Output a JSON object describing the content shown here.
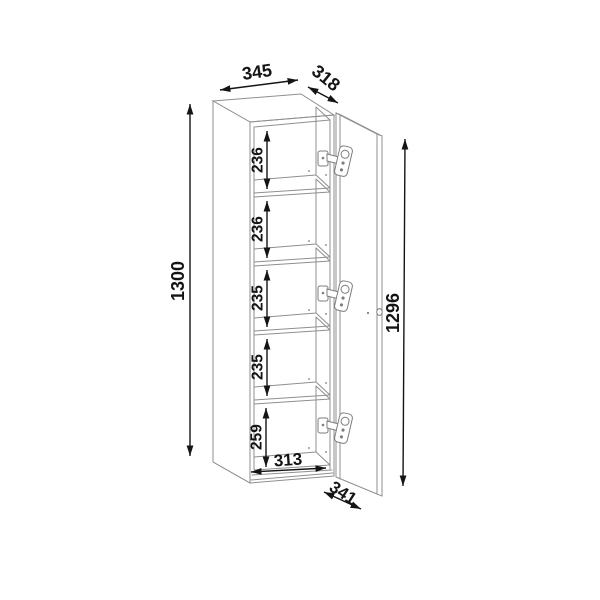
{
  "diagram": {
    "kind": "furniture-technical-drawing",
    "object": "tall five-compartment cabinet with open right-hinged door",
    "units": "mm",
    "dims": {
      "width_top": "345",
      "depth_top": "318",
      "height_left": "1300",
      "door_height": "1296",
      "door_swing_depth": "341",
      "interior_width": "313",
      "compartment_heights": [
        "236",
        "236",
        "235",
        "235",
        "259"
      ]
    },
    "colors": {
      "outline": "#8f8f8f",
      "dimension": "#141414",
      "background": "#ffffff"
    }
  }
}
